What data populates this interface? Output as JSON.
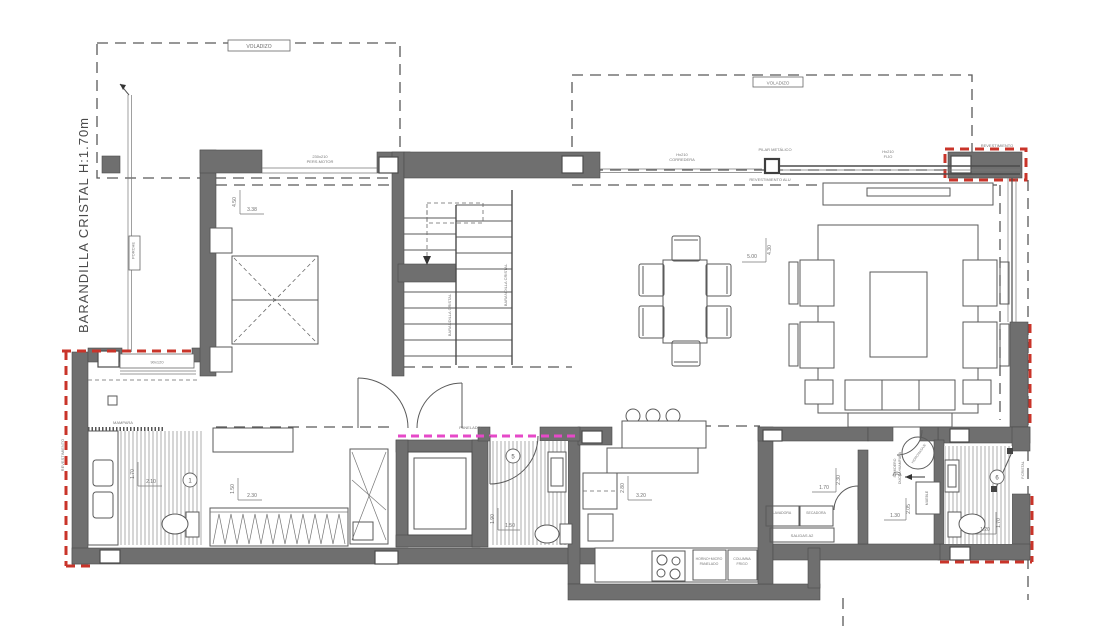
{
  "plan": {
    "title": "Planta vivienda - distribución",
    "colors": {
      "wall": "#6f6f6f",
      "cladding_red": "#c9342a",
      "panelado_magenta": "#e649c8",
      "line": "#5a5a5a"
    },
    "annotations": {
      "barandilla_left": "BARANDILLA CRISTAL   H:1.70m",
      "voladizo_left": "VOLADIZO",
      "voladizo_right": "VOLADIZO",
      "porche": "PORCHE",
      "pers_motor_line1": "230x210",
      "pers_motor_line2": "PERS.MOTOR",
      "corredera_line1": "Hx210",
      "corredera_line2": "CORREDERA",
      "pilar_metalico": "PILAR METÁLICO",
      "fijo_line1": "Hx210",
      "fijo_line2": "FIJO",
      "revestimiento_alu": "REVESTIMIENTO ALU",
      "revestimiento_right": "REVESTIMIENTO",
      "revestimiento_left": "REVESTIMIENTO",
      "stair_rail_inner": "BARANDILLA CRISTAL",
      "stair_rail_outer": "BARANDILLA CRISTAL",
      "panelado": "PANELADO",
      "mampara": "MAMPARA",
      "window_master": "90x120",
      "lavadora": "LAVADORA",
      "secadora": "SECADORA",
      "salidas": "SALIDAS A2",
      "horno_line1": "HORNO+MICRO",
      "horno_line2": "PANELADO",
      "frigo_line1": "COLUMNA",
      "frigo_line2": "FRIGO",
      "sumidero_line1": "SUMIDERO",
      "sumidero_line2": "DUCHA+MAMPARA",
      "ducha_circle": "HIDROMASAJE",
      "mueble": "MUEBLE",
      "puerta_bath6": "P.CRISTAL"
    },
    "dimensions": {
      "bedroom_v": "4.50",
      "bedroom_h": "3.38",
      "living_h": "5.00",
      "living_v": "4.30",
      "kitchen_v": "2.80",
      "kitchen_h": "3.20",
      "laundry_v": "2.30",
      "laundry_h": "1.70",
      "bath3_v": "2.05",
      "bath3_h": "1.30",
      "bath5_v": "1.90",
      "bath5_h": "1.50",
      "master_v": "1.70",
      "master_h": "2.10",
      "wardrobe_v": "1.50",
      "wardrobe_h": "2.30",
      "bath6_v": "1.70",
      "bath6_h": "1.20"
    },
    "room_numbers": {
      "master_bath": "1",
      "guest_bath": "5",
      "pool_bath": "6"
    }
  }
}
